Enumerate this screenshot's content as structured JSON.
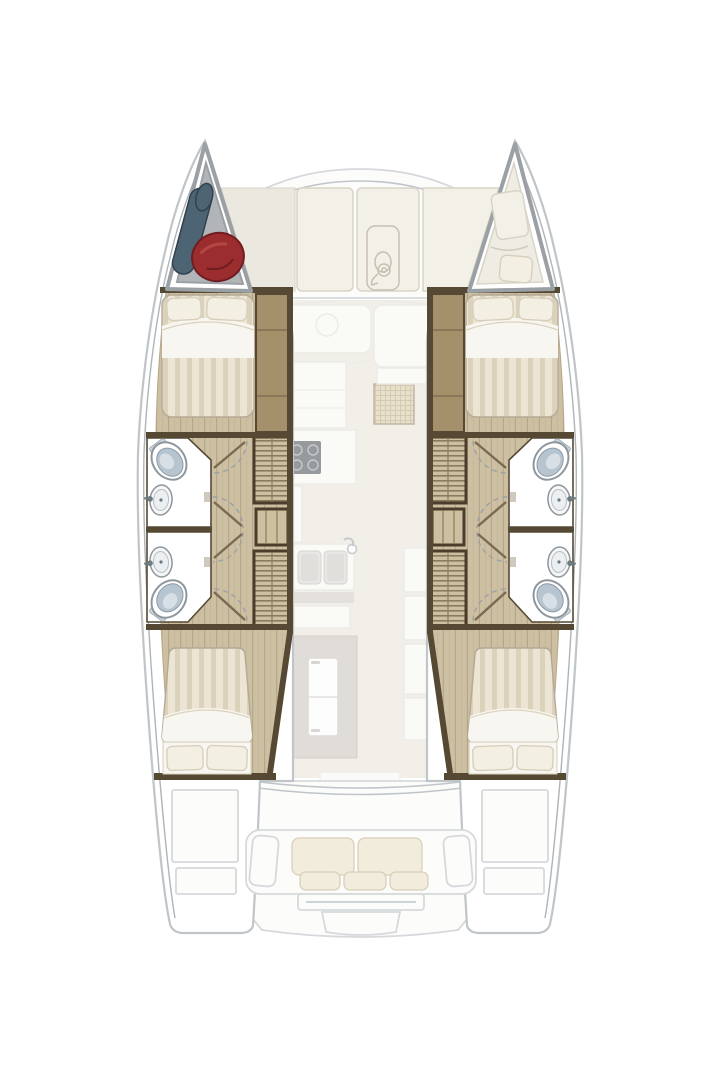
{
  "diagram": {
    "type": "yacht-deck-plan",
    "subject": "sailing catamaran interior layout, top-down view",
    "cabins": 4,
    "bathrooms": 4,
    "visible_text": ""
  },
  "labels": {
    "plan": "Catamaran deck plan",
    "port_hull": "Port hull",
    "starboard_hull": "Starboard hull",
    "foredeck": "Foredeck lounge cushions",
    "bow_locker": "Port bow locker with fenders",
    "bow_berth": "Starboard forepeak berth",
    "forward_cabin": "Forward double cabin",
    "aft_cabin": "Aft double cabin",
    "forward_bathroom": "Forward bathroom",
    "aft_bathroom": "Aft bathroom",
    "stairs": "Companionway stairs",
    "saloon": "Saloon and galley",
    "stove": "Galley stove",
    "galley_sink": "Galley double sink",
    "fridge": "Refrigerator cabinet",
    "rattan_mat": "Rattan floor mat",
    "cockpit": "Aft cockpit",
    "cockpit_sofa": "Cockpit sofa",
    "windlass": "Anchor windlass",
    "toilet": "Marine toilet",
    "washbasin": "Washbasin",
    "wardrobe": "Wardrobe",
    "bed": "Double bed",
    "cockpit_locker": "Cockpit bench locker",
    "transom_steps": "Transom steps"
  },
  "icons": [
    "windlass-icon",
    "toilet-icon",
    "washbasin-icon",
    "stove-icon",
    "fridge-icon",
    "sink-icon",
    "fender-icon",
    "door-swing-arc"
  ],
  "colors": {
    "page-bg": "#ffffff",
    "hull-stroke": "#bfc5c9",
    "gunwale": "#aeb4b8",
    "deck-fill": "#fcfcfb",
    "deck-line": "#d6d9db",
    "foredeck-cushion": "#f3f0e7",
    "foredeck-cushion-line": "#d8d4c7",
    "deck-fillet": "#eae8df",
    "berth-floor": "#efece3",
    "bow-frame": "#9aa0a4",
    "bow-locker": "#b1b5b8",
    "fender-red": "#9c2d2e",
    "fender-red-dark": "#6f1d20",
    "fender-blue": "#4c6474",
    "fender-blue-dark": "#32414c",
    "wood-floor": "#ccbfa2",
    "wood-line": "#b5a787",
    "wall": "#564934",
    "wardrobe": "#a5906c",
    "stair-bg": "#cdc0a1",
    "stair-line": "#8a7a5c",
    "stair-frame": "#4a3d2c",
    "duvet-base": "#ece5d4",
    "duvet-stripe": "#dcd2bc",
    "bed-edge": "#b3a996",
    "sheet-white": "#f8f6f0",
    "pillow": "#f4efe3",
    "pillow-line": "#d7cfbc",
    "fixture-stroke": "#8e979d",
    "toilet-seat": "#b7c5d1",
    "toilet-hi": "#dce4ea",
    "sink-fill": "#f5f7f8",
    "door-arc": "#9aa2a8",
    "door-leaf": "#7a6a52",
    "saloon-floor": "#e9e3d7",
    "counter": "#f7f6f2",
    "counter-line": "#dedbd4",
    "counter-gray": "#cfcac1",
    "cabinet-gray": "#c7c1b9",
    "fridge": "#fdfdfc",
    "stove": "#43484e",
    "stove-ring": "#9aa0a6",
    "rattan": "#d8c7a2",
    "rattan-line": "#b49e74",
    "rattan-edge": "#8d7a58",
    "basin": "#d7d5d0",
    "windlass-line": "#c6c0b2",
    "sofa-cushion": "#f2ecdc",
    "sofa-cushion-line": "#d8d0ba"
  }
}
